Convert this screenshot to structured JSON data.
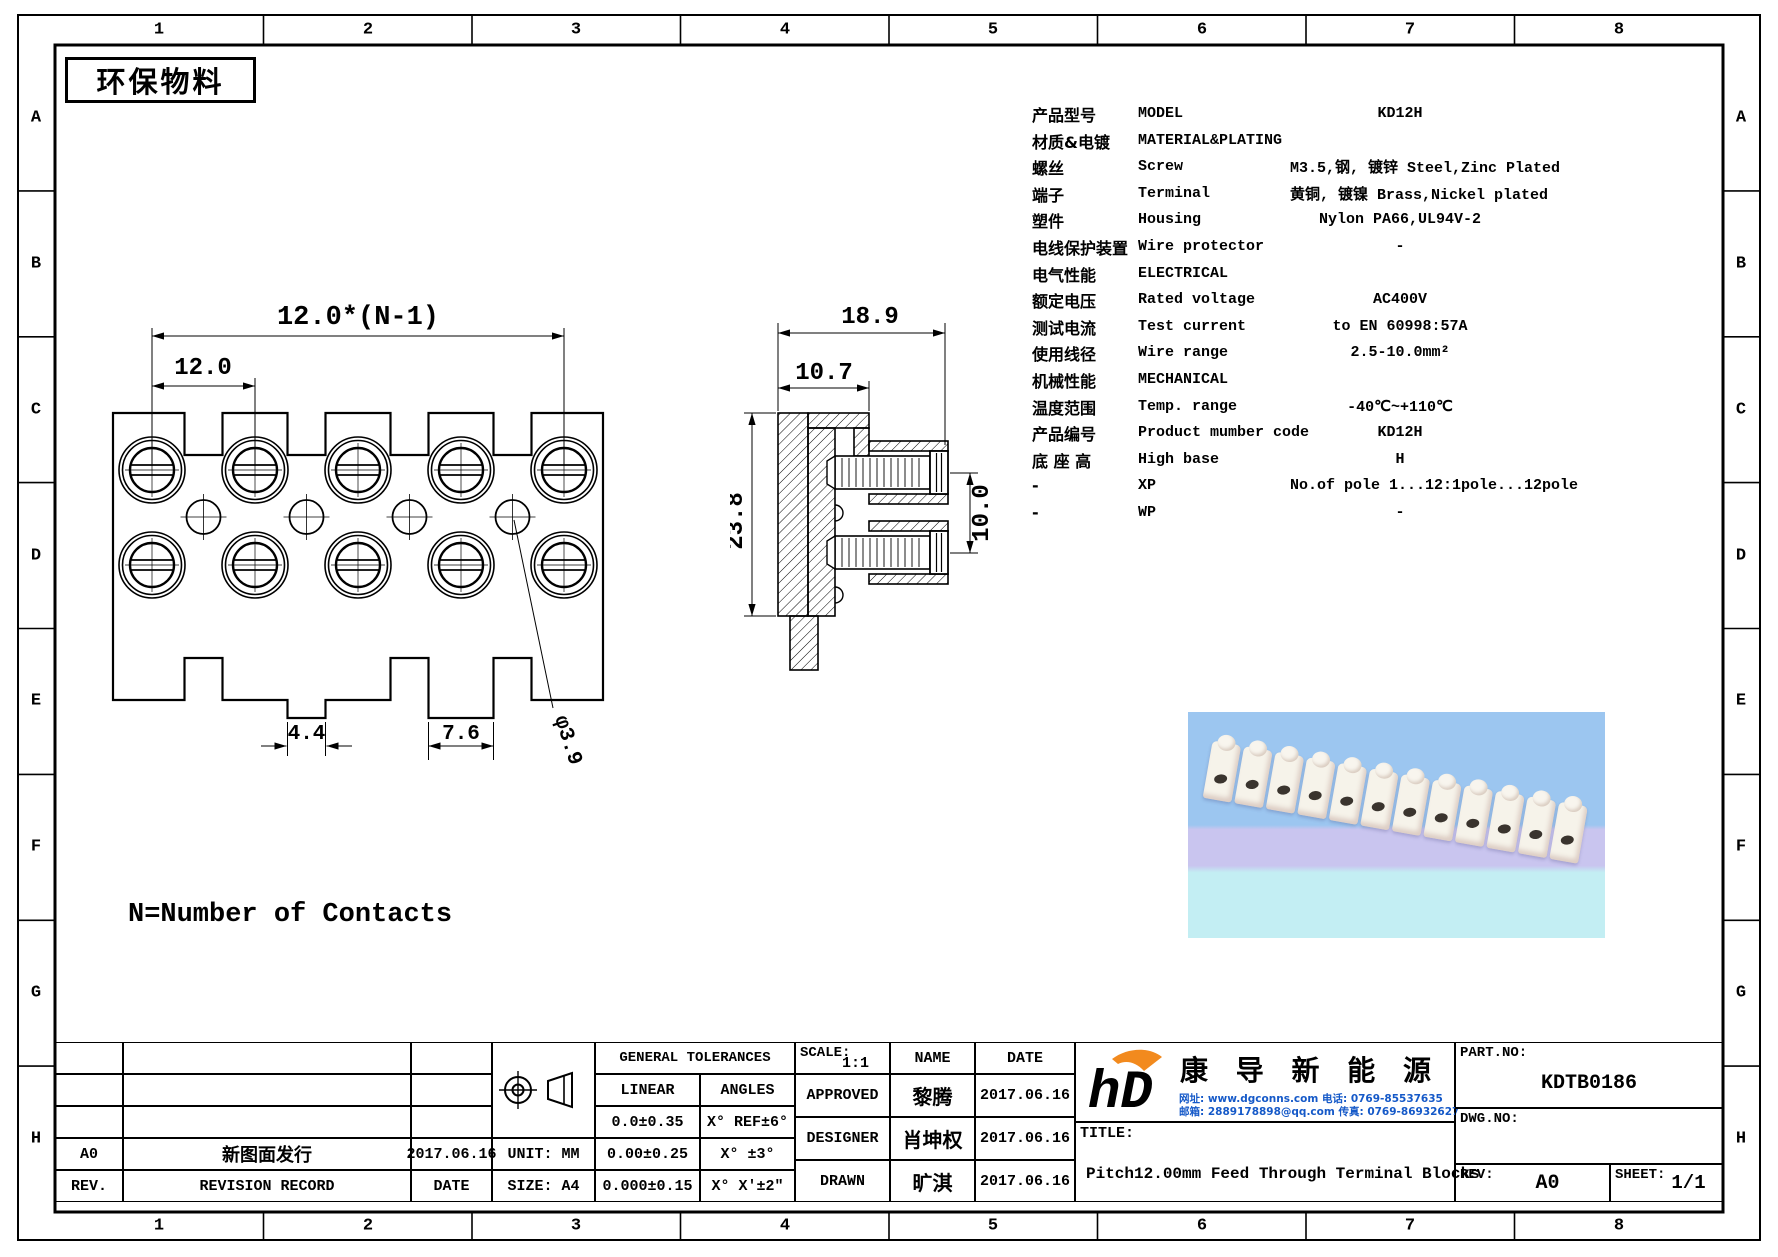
{
  "sheet": {
    "eco_label": "环保物料",
    "note": "N=Number of Contacts",
    "grid_cols": [
      "1",
      "2",
      "3",
      "4",
      "5",
      "6",
      "7",
      "8"
    ],
    "grid_rows": [
      "A",
      "B",
      "C",
      "D",
      "E",
      "F",
      "G",
      "H"
    ]
  },
  "spec_table": {
    "rows": [
      {
        "cn": "产品型号",
        "en": "MODEL",
        "val": "KD12H"
      },
      {
        "cn": "材质&电镀",
        "en": "MATERIAL&PLATING",
        "val": ""
      },
      {
        "cn": "螺丝",
        "en": "Screw",
        "val": "M3.5,钢, 镀锌 Steel,Zinc Plated"
      },
      {
        "cn": "端子",
        "en": "Terminal",
        "val": "黄铜, 镀镍 Brass,Nickel plated"
      },
      {
        "cn": "塑件",
        "en": "Housing",
        "val": "Nylon PA66,UL94V-2"
      },
      {
        "cn": "电线保护装置",
        "en": "Wire protector",
        "val": "-"
      },
      {
        "cn": "电气性能",
        "en": "ELECTRICAL",
        "val": ""
      },
      {
        "cn": "额定电压",
        "en": "Rated voltage",
        "val": "AC400V"
      },
      {
        "cn": "测试电流",
        "en": "Test current",
        "val": "to EN 60998:57A"
      },
      {
        "cn": "使用线径",
        "en": "Wire range",
        "val": "2.5-10.0mm²"
      },
      {
        "cn": "机械性能",
        "en": "MECHANICAL",
        "val": ""
      },
      {
        "cn": "温度范围",
        "en": "Temp. range",
        "val": "-40℃~+110℃"
      },
      {
        "cn": "产品编号",
        "en": "Product mumber code",
        "val": "KD12H"
      },
      {
        "cn": "底 座 高",
        "en": "High base",
        "val": "H"
      },
      {
        "cn": "-",
        "en": "XP",
        "val": "No.of pole 1...12:1pole...12pole"
      },
      {
        "cn": "-",
        "en": "WP",
        "val": "-"
      }
    ]
  },
  "front_view": {
    "dims": {
      "pitch_total": "12.0*(N-1)",
      "pitch": "12.0",
      "gap": "4.4",
      "tab": "7.6",
      "hole": "φ3.9"
    }
  },
  "side_view": {
    "dims": {
      "width": "18.9",
      "inner_width": "10.7",
      "height": "23.8",
      "screw_span": "10.0"
    }
  },
  "title_block": {
    "revision": {
      "rev": "A0",
      "record": "新图面发行",
      "date": "2017.06.16",
      "rev_h": "REV.",
      "record_h": "REVISION RECORD",
      "date_h": "DATE"
    },
    "unit": "UNIT: MM",
    "size": "SIZE: A4",
    "tolerances": {
      "header": "GENERAL TOLERANCES",
      "linear_h": "LINEAR",
      "angles_h": "ANGLES",
      "rows": [
        [
          "0.0±0.35",
          "X° REF±6°"
        ],
        [
          "0.00±0.25",
          "X° ±3°"
        ],
        [
          "0.000±0.15",
          "X° X'±2\""
        ]
      ]
    },
    "scale_label": "SCALE:",
    "scale": "1:1",
    "name_h": "NAME",
    "date_h": "DATE",
    "signers": [
      {
        "role": "APPROVED",
        "name": "黎腾",
        "date": "2017.06.16"
      },
      {
        "role": "DESIGNER",
        "name": "肖坤权",
        "date": "2017.06.16"
      },
      {
        "role": "DRAWN",
        "name": "旷淇",
        "date": "2017.06.16"
      }
    ],
    "company": "康 导 新 能 源",
    "contact1": "网址: www.dgconns.com  电话: 0769-85537635",
    "contact2": "邮箱: 2889178898@qq.com 传真: 0769-86932627",
    "title_label": "TITLE:",
    "title": "Pitch12.00mm Feed Through Terminal Blocks",
    "part_no_label": "PART.NO:",
    "part_no": "KDTB0186",
    "dwg_no_label": "DWG.NO:",
    "rev_label": "REV:",
    "rev": "A0",
    "sheet_label": "SHEET:",
    "sheet": "1/1"
  },
  "photo": {
    "description": "12-pole feed-through terminal block strip",
    "poles": 12
  },
  "colors": {
    "line": "#000000",
    "logo_blue": "#2aa0dc",
    "logo_orange": "#f28a1e",
    "contact_blue": "#1559c8",
    "photo_sky": "#9cc6f0",
    "photo_lavender": "#c9c5ef",
    "photo_cyan": "#c3eef3"
  }
}
